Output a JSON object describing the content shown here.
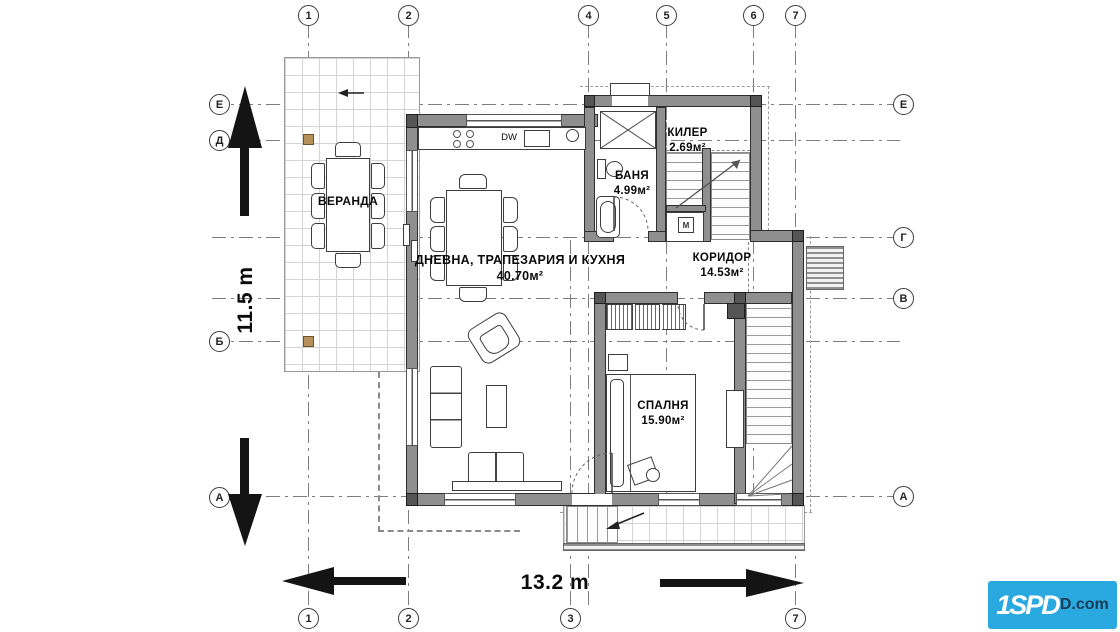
{
  "grid": {
    "top": [
      "1",
      "2",
      "4",
      "5",
      "6",
      "7"
    ],
    "bottom": [
      "1",
      "2",
      "3",
      "7"
    ],
    "left": [
      "Е",
      "Д",
      "Б",
      "А"
    ],
    "right": [
      "Е",
      "Г",
      "В",
      "А"
    ]
  },
  "rooms": {
    "veranda": {
      "name": "ВЕРАНДА"
    },
    "living": {
      "name": "ДНЕВНА, ТРАПЕЗАРИЯ И КУХНЯ",
      "area": "40.70м²"
    },
    "pantry": {
      "name": "КИЛЕР",
      "area": "2.69м²"
    },
    "bath": {
      "name": "БАНЯ",
      "area": "4.99м²"
    },
    "corridor": {
      "name": "КОРИДОР",
      "area": "14.53м²"
    },
    "bedroom": {
      "name": "СПАЛНЯ",
      "area": "15.90м²"
    }
  },
  "dimensions": {
    "vertical": "11.5 m",
    "horizontal": "13.2 m"
  },
  "kitchen": {
    "dishwasher": "DW"
  },
  "laundry": {
    "machine": "M"
  },
  "logo": {
    "primary": "1SPD",
    "secondary": "D.com",
    "bg_color": "#29a9e0"
  },
  "colors": {
    "wall": "#8f8f8f",
    "accent_post": "#b5905a",
    "arrow": "#141414"
  }
}
